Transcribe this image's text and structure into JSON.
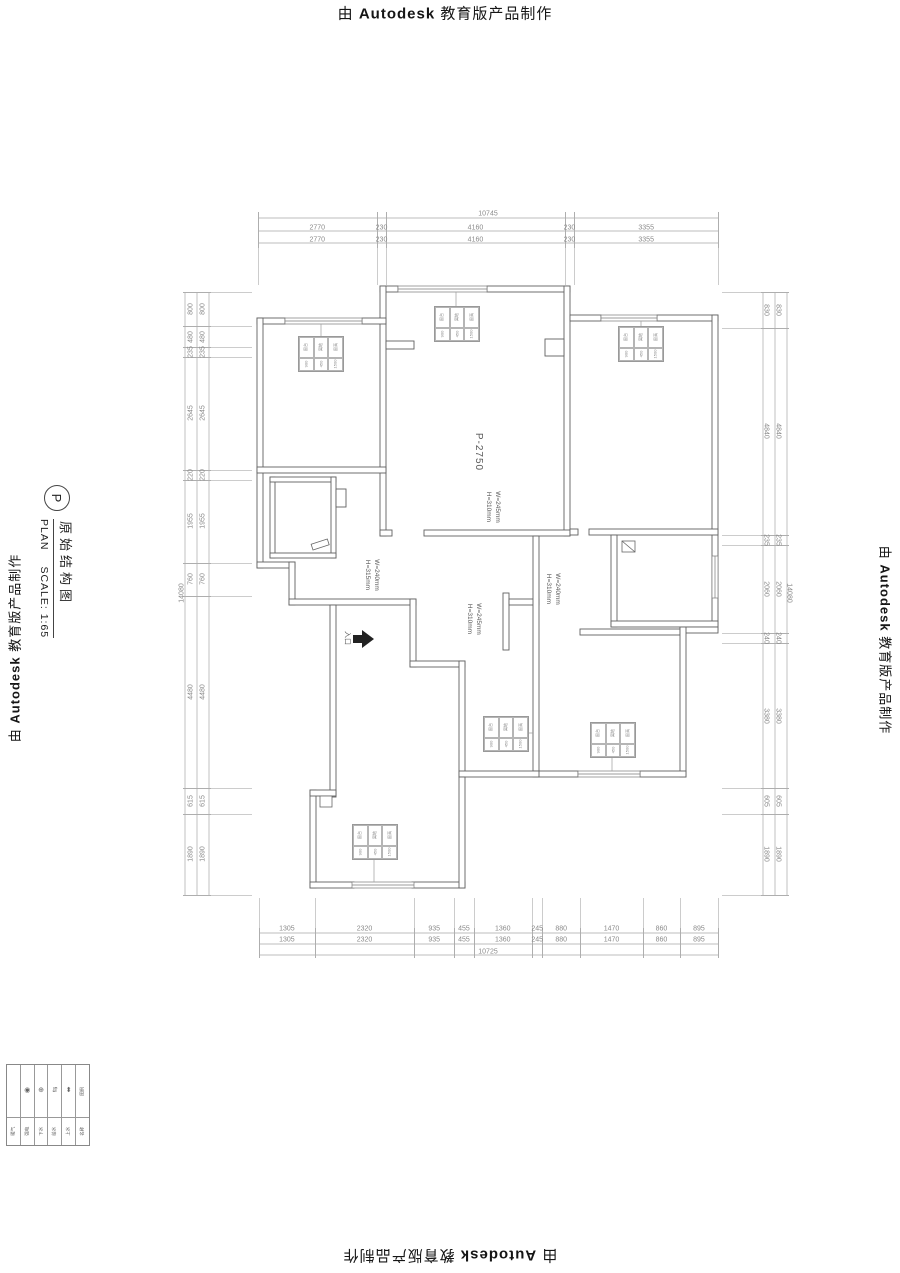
{
  "stamp": {
    "prefix": "由",
    "brand": "Autodesk",
    "suffix": "教育版产品制作"
  },
  "title_block": {
    "tag": "P",
    "title": "原始结构图",
    "plan_word": "PLAN",
    "scale": "SCALE: 1:65"
  },
  "dimensions": {
    "top": {
      "total": "10745",
      "segments": [
        "2770",
        "230",
        "4160",
        "230",
        "3355"
      ]
    },
    "bottom": {
      "total": "10725",
      "segments": [
        "1305",
        "2320",
        "935",
        "455",
        "1360",
        "245",
        "880",
        "1470",
        "860",
        "895"
      ]
    },
    "left": {
      "total": "14080",
      "segments": [
        "800",
        "480",
        "235",
        "2645",
        "220",
        "1955",
        "760",
        "4480",
        "615",
        "1890"
      ]
    },
    "right": {
      "total": "14080",
      "segments": [
        "830",
        "4840",
        "235",
        "2060",
        "240",
        "3380",
        "605",
        "1890"
      ]
    }
  },
  "plan_labels": {
    "room_beam": "P-2750",
    "wall_center": "W=245mm\nH=310mm",
    "wall_hall_left": "W=240mm\nH=315mm",
    "wall_hall_mid": "W=245mm\nH=310mm",
    "wall_hall_right": "W=240mm\nH=310mm",
    "entrance": "入口"
  },
  "window_tags": {
    "r1": [
      "窗台",
      "离地",
      "窗高"
    ],
    "r2": [
      "900",
      "450",
      "1500"
    ]
  },
  "legend": {
    "columns": [
      {
        "symbol": "",
        "label": "暖气"
      },
      {
        "symbol": "◉",
        "label": "强电"
      },
      {
        "symbol": "⊕",
        "label": "下水"
      },
      {
        "symbol": "⇵",
        "label": "给水"
      },
      {
        "symbol": "⬍",
        "label": "上水"
      },
      {
        "symbol": "图例",
        "label": "名称"
      }
    ]
  },
  "colors": {
    "wall": "#666666",
    "dim": "#9a9a9a",
    "text": "#555555"
  }
}
